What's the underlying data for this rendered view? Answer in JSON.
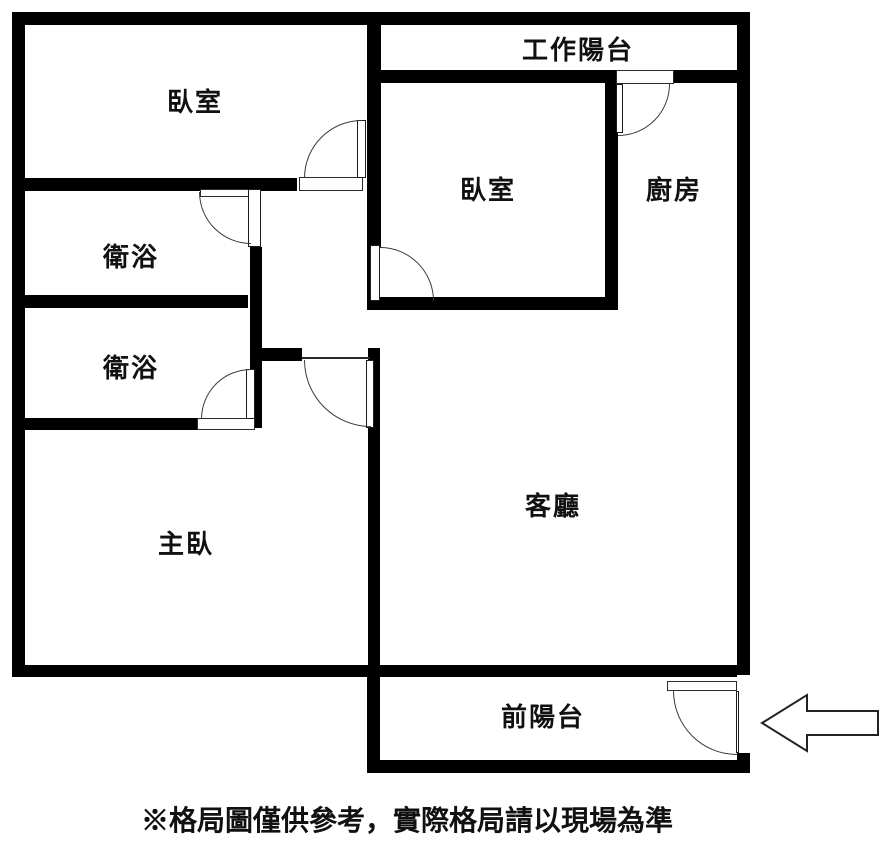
{
  "page": {
    "background": "#ffffff",
    "type_note": "apartment floor plan, black walls on white"
  },
  "colors": {
    "wall": "#000000",
    "door_line": "#3b3b3b",
    "text": "#111111",
    "background": "#ffffff"
  },
  "rooms": {
    "bedroom_top_left": {
      "label": "臥室"
    },
    "work_balcony": {
      "label": "工作陽台"
    },
    "bedroom_center": {
      "label": "臥室"
    },
    "kitchen": {
      "label": "廚房"
    },
    "bathroom_upper": {
      "label": "衛浴"
    },
    "bathroom_lower": {
      "label": "衛浴"
    },
    "master_bedroom": {
      "label": "主臥"
    },
    "living_room": {
      "label": "客廳"
    },
    "front_balcony": {
      "label": "前陽台"
    }
  },
  "footer": {
    "disclaimer": "※格局圖僅供參考，實際格局請以現場為準"
  },
  "icons": {
    "entrance_arrow": "arrow-left"
  }
}
